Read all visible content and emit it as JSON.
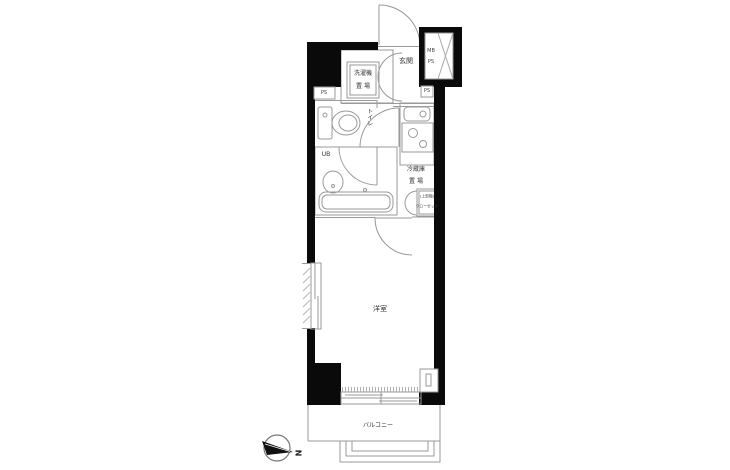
{
  "floor_plan": {
    "labels": {
      "entrance": "玄関",
      "mb": "MB",
      "ps_shaft": "PS",
      "ps_left": "PS",
      "ps_right": "PS",
      "washer_l1": "洗濯機",
      "washer_l2": "置 場",
      "toilet": "トイレ",
      "unit_bath": "UB",
      "fridge_l1": "冷蔵庫",
      "fridge_l2": "置 場",
      "storage_l1": "(上部棚)",
      "storage_l2": "クローゼット",
      "main_room": "洋室",
      "balcony": "バルコニー",
      "north": "N"
    },
    "colors": {
      "wall": "#0a0a0a",
      "line": "#9a9a9a",
      "text": "#333333",
      "background": "#ffffff"
    }
  }
}
